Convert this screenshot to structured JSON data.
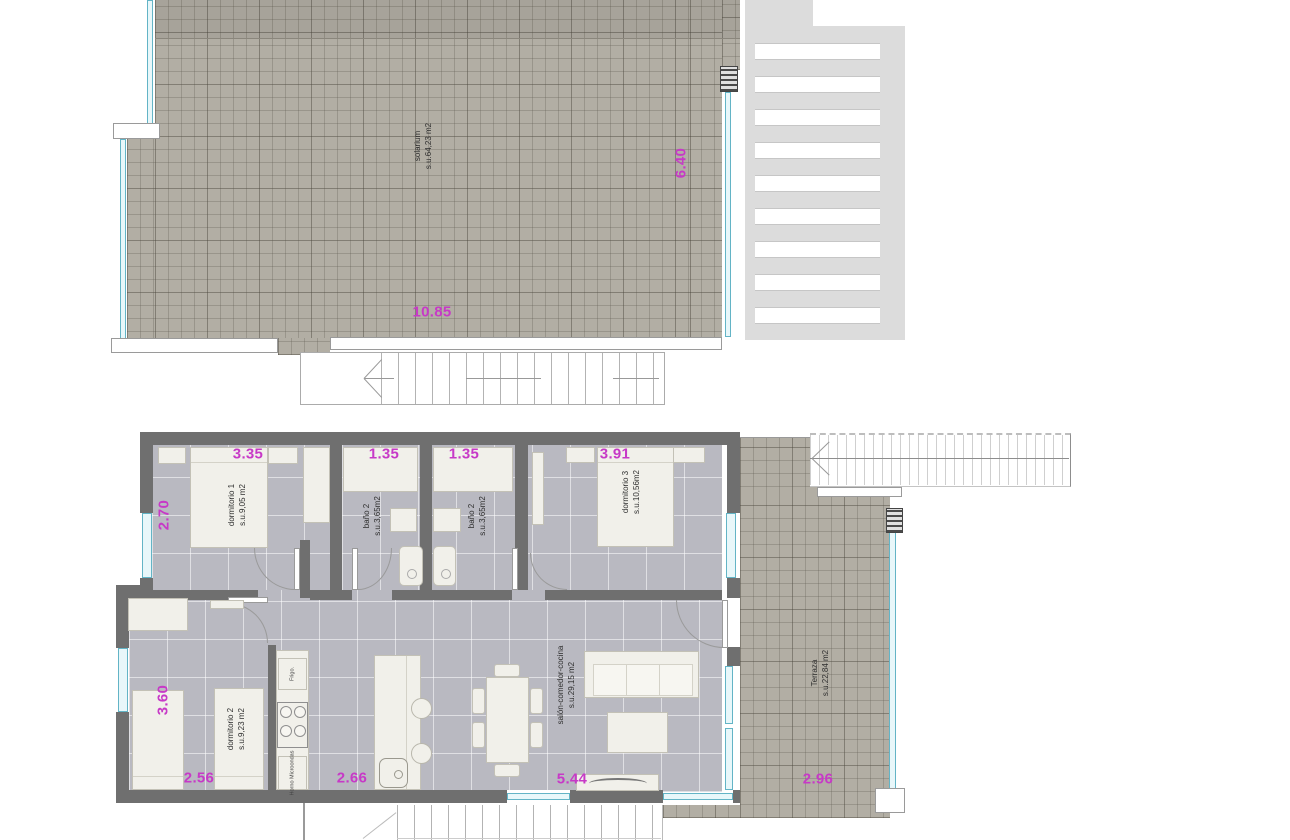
{
  "upper": {
    "solarium_label": "solarium",
    "solarium_area": "s.u.64,23 m2",
    "dim_w": "10.85",
    "dim_h": "6.40"
  },
  "lower": {
    "d1_label": "dormitorio 1",
    "d1_area": "s.u.9,05 m2",
    "d1_dim_top": "3.35",
    "d1_dim_left": "2.70",
    "ba_label": "baño 2",
    "ba_area": "s.u.3,65m2",
    "ba_dim": "1.35",
    "bb_label": "baño 2",
    "bb_area": "s.u.3,65m2",
    "bb_dim": "1.35",
    "d3_label": "dormitorio 3",
    "d3_area": "s.u.10,56m2",
    "d3_dim_top": "3.91",
    "d2_label": "dormitorio 2",
    "d2_area": "s.u.9,23 m2",
    "d2_dim_left": "3.60",
    "d2_dim_bottom": "2.56",
    "kitchen_dim": "2.66",
    "fridge": "Frigo.",
    "oven_l1": "Horno",
    "oven_l2": "Microondas",
    "salon_label": "salón-comedor-cocina",
    "salon_area": "s.u.29,15 m2",
    "salon_dim": "5.44",
    "terr_label": "Terraza",
    "terr_area": "s.u.22,84 m2",
    "terr_dim": "2.96"
  },
  "colors": {
    "dimension_magenta": "#c739c7",
    "wall_gray": "#6f6f6f",
    "solarium_beige": "#b2aea4",
    "floor_tile": "#b9b9c1",
    "glass_cyan": "#e8f7fa"
  }
}
